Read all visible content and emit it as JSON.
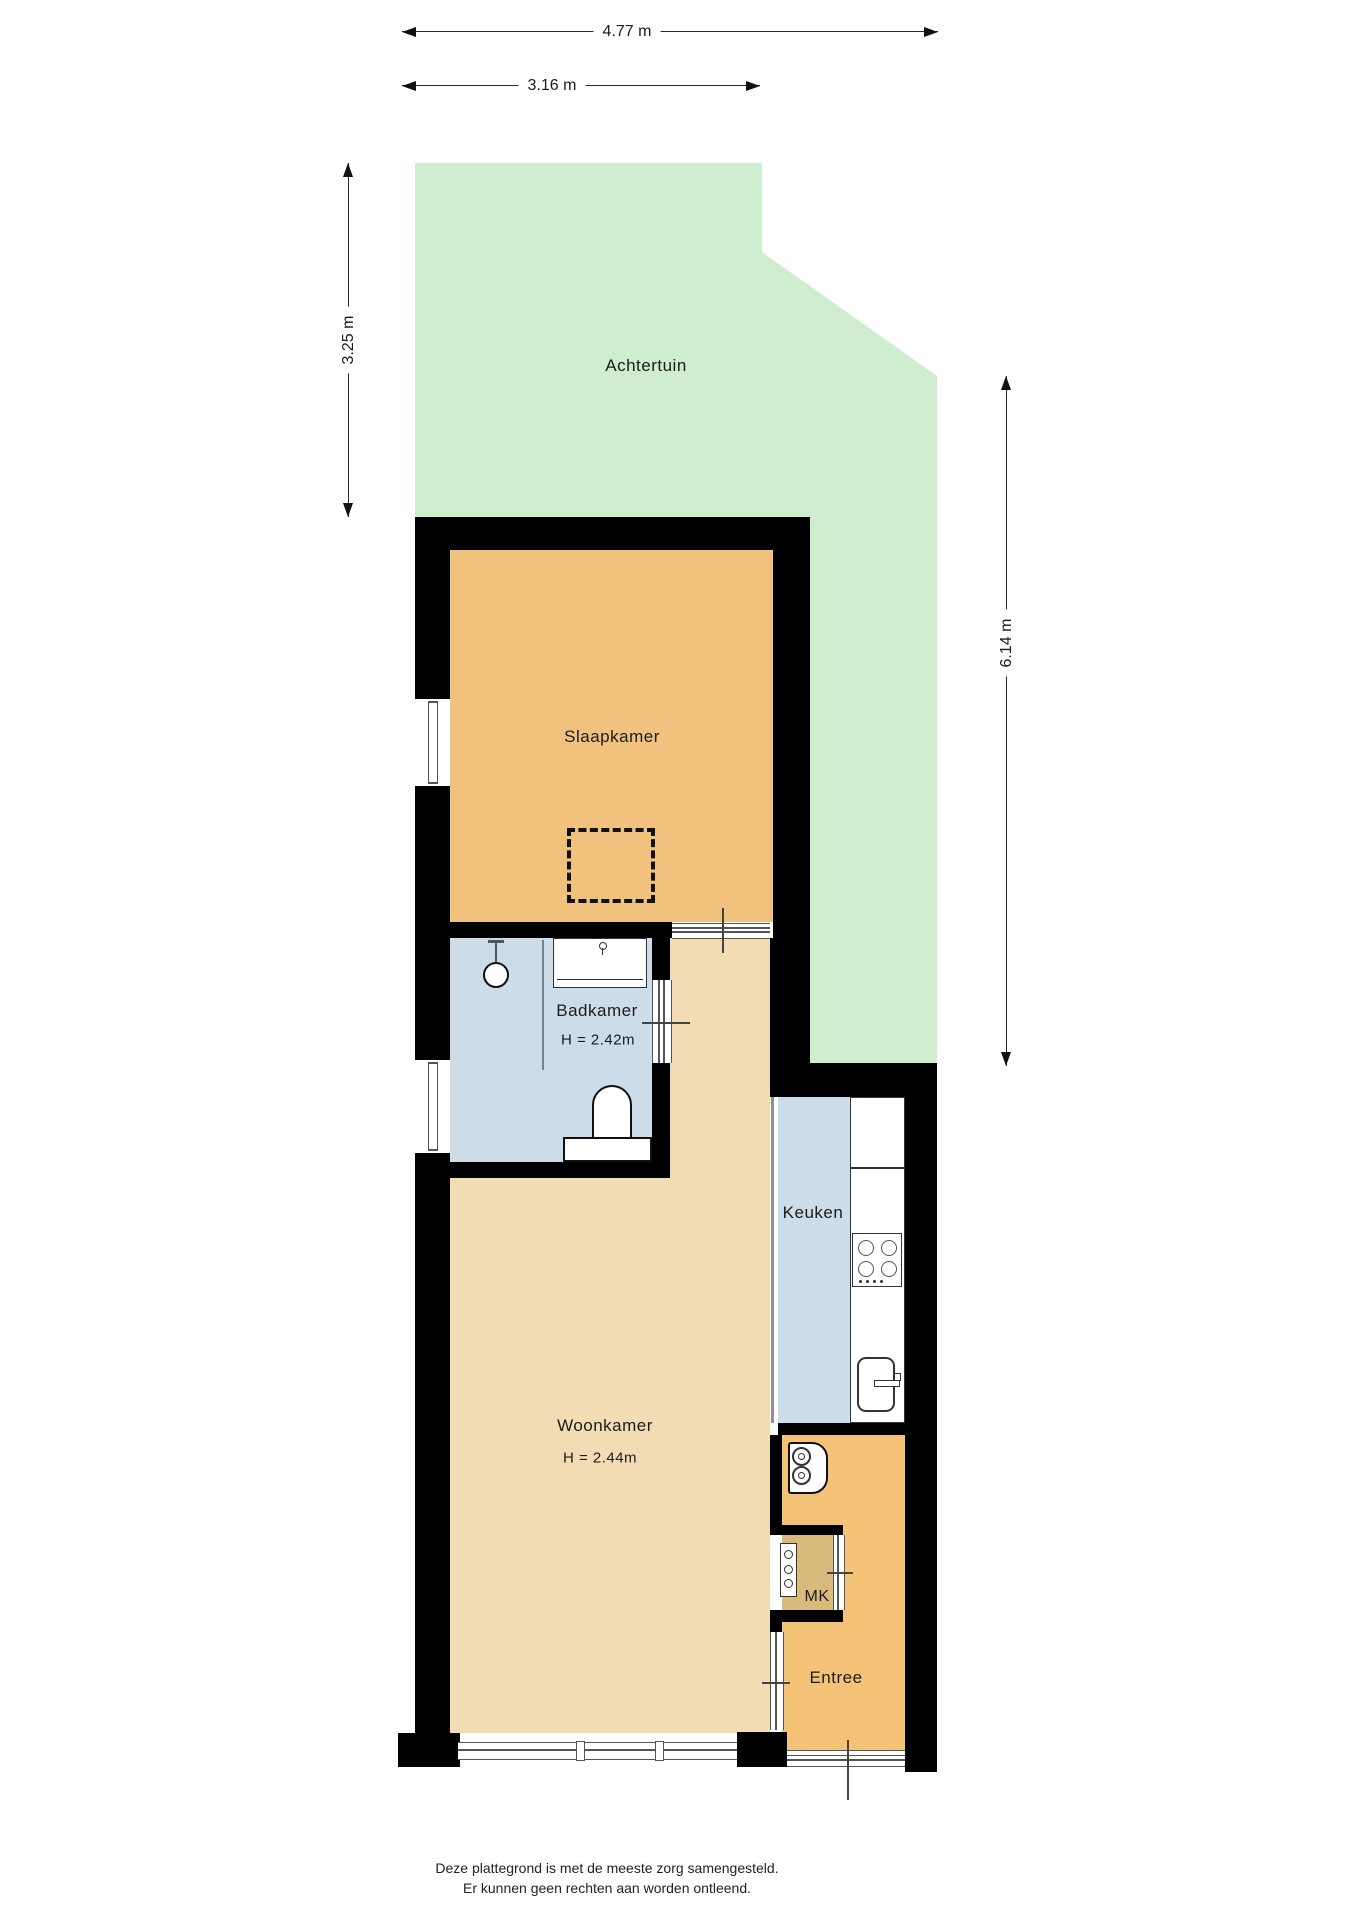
{
  "dimensions": {
    "top_outer": "4.77 m",
    "top_inner": "3.16 m",
    "left": "3.25 m",
    "right": "6.14 m"
  },
  "rooms": {
    "garden": {
      "label": "Achtertuin"
    },
    "bedroom": {
      "label": "Slaapkamer"
    },
    "bathroom": {
      "label": "Badkamer",
      "height": "H = 2.42m"
    },
    "kitchen": {
      "label": "Keuken"
    },
    "living_room": {
      "label": "Woonkamer",
      "height": "H = 2.44m"
    },
    "entry": {
      "label": "Entree"
    },
    "meter_closet": {
      "label": "MK"
    }
  },
  "footer": {
    "line1": "Deze plattegrond is met de meeste zorg samengesteld.",
    "line2": "Er kunnen geen rechten aan worden ontleend."
  },
  "colors": {
    "garden": "#cfedcf",
    "bedroom": "#f0c27d",
    "bathroom": "#ccdce9",
    "kitchen": "#ccdce9",
    "living_room": "#f2dcb3",
    "entry": "#f4c377",
    "meter_closet": "#d9ba7d",
    "wall": "#000000"
  }
}
